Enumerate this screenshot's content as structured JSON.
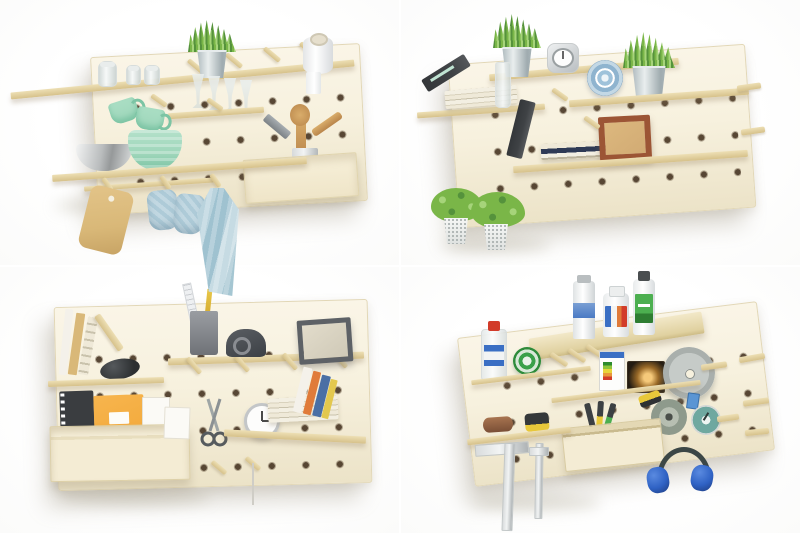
{
  "scene": {
    "title": "Wooden pegboard wall organizer shown in four styled settings",
    "layout": "2x2 product-photo collage on white background",
    "panels": [
      {
        "id": "kitchen",
        "position": "top-left",
        "items": [
          "grass plant in zinc bucket",
          "glass jars",
          "paper towel roll",
          "wine glasses",
          "two mint mugs on hooks",
          "stainless steel bowl",
          "mint mixing bowl",
          "wooden utensil box with spoon and spatulas",
          "bamboo cutting board",
          "two light-blue oven mitts",
          "light-blue kitchen towel",
          "wooden shelves and pegs"
        ]
      },
      {
        "id": "living-room",
        "position": "top-right",
        "items": [
          "two grass plants in zinc buckets",
          "silver alarm clock",
          "blue mandala plate",
          "leaning dark book",
          "horizontal book stacks",
          "glass vase",
          "brown wooden picture frame",
          "two hanging perforated pots with greenery",
          "wooden shelves and pegs"
        ]
      },
      {
        "id": "home-office",
        "position": "bottom-left",
        "items": [
          "upright books with sloped support",
          "black computer mouse",
          "gray pencil cup with ruler and pencil",
          "dark tape dispenser",
          "dark picture frame",
          "wooden storage box",
          "spiral notebook",
          "orange notepad",
          "white notepad",
          "sketch card",
          "hanging scissors",
          "white alarm clock",
          "stack of books",
          "leaning colorful books",
          "wooden shelves and pegs"
        ]
      },
      {
        "id": "workshop",
        "position": "bottom-right",
        "items": [
          "spray can",
          "two product bottles",
          "solvent bottle with red cap",
          "green tape roll",
          "light-bulb box with energy label",
          "boxed glowing bulb",
          "circular saw blade on peg",
          "yellow utility knife",
          "grinding disc",
          "pressure gauge",
          "pliers",
          "black-and-yellow tape measure",
          "sandpaper roll",
          "wooden crate",
          "metal try square",
          "caliper",
          "blue ear defenders",
          "wooden shelves and pegs"
        ]
      }
    ]
  },
  "palette": {
    "board": "#f7f1de",
    "board-dark": "#ece3c8",
    "board-edge": "#e2d7b6",
    "hole": "#4a3826",
    "shelf-light": "#eddfb4",
    "shelf-dark": "#d6c18a",
    "mint": "#9ed6ba",
    "mint-dark": "#7cc4a4",
    "steel-light": "#f2f3f3",
    "steel-dark": "#96999a",
    "textile-blue": "#aecbd8",
    "towel-blue": "#9fc2d0",
    "wood-tan": "#d9b878",
    "plant-green": "#7ab648",
    "plant-dark": "#55923c",
    "plant-light": "#a6d47a",
    "bucket-light": "#e9eeee",
    "bucket-dark": "#aab6ba",
    "frame-brown": "#9c5535",
    "frame-inner": "#d2ab74",
    "frame-gray": "#5d6166",
    "dark-item": "#3f4245",
    "orange-pad": "#f2a93b",
    "navy-book": "#2e3a55",
    "blue-book": "#4a6fa5",
    "yellow-book": "#e3c84e",
    "orange-book": "#e07b3a",
    "earmuff-blue": "#2f62c4",
    "earmuff-dark": "#3c4746",
    "saw-silver": "#c6cbc8",
    "tape-green": "#3aa04a",
    "gauge-teal": "#6fa8a0",
    "knife-yellow": "#e8c83a",
    "label-green": "#4caf50",
    "label-blue": "#3a6fc4",
    "label-red": "#d23c2a"
  }
}
